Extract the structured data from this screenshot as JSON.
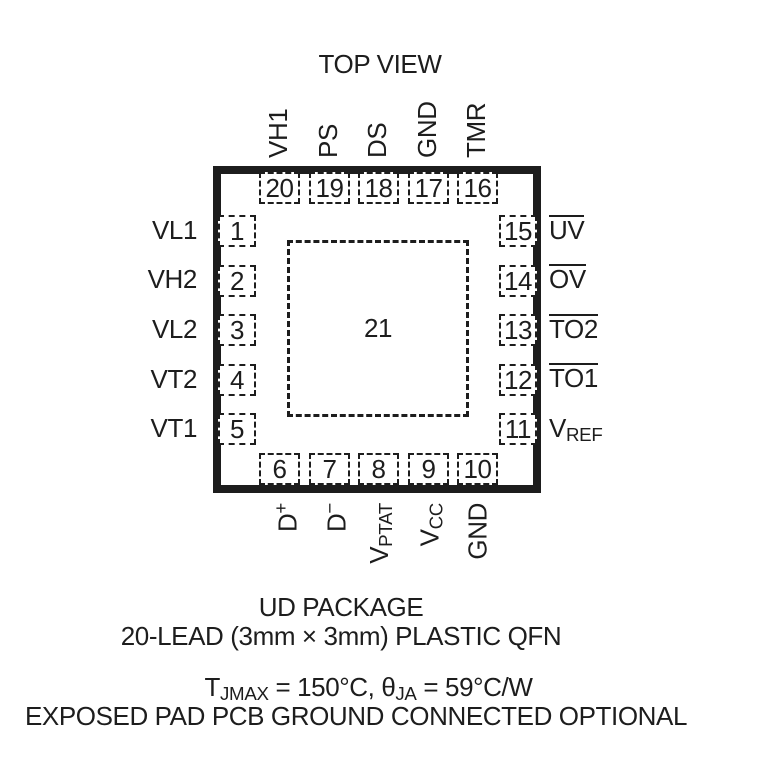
{
  "title": "TOP VIEW",
  "ink_color": "#1d1d1d",
  "package": {
    "center_pad_number": "21",
    "top_pins": [
      {
        "number": "20",
        "label": "VH1"
      },
      {
        "number": "19",
        "label": "PS"
      },
      {
        "number": "18",
        "label": "DS"
      },
      {
        "number": "17",
        "label": "GND"
      },
      {
        "number": "16",
        "label": "TMR"
      }
    ],
    "left_pins": [
      {
        "number": "1",
        "label": "VL1"
      },
      {
        "number": "2",
        "label": "VH2"
      },
      {
        "number": "3",
        "label": "VL2"
      },
      {
        "number": "4",
        "label": "VT2"
      },
      {
        "number": "5",
        "label": "VT1"
      }
    ],
    "right_pins": [
      {
        "number": "15",
        "label": "UV",
        "overline": true
      },
      {
        "number": "14",
        "label": "OV",
        "overline": true
      },
      {
        "number": "13",
        "label": "TO2",
        "overline": true
      },
      {
        "number": "12",
        "label": "TO1",
        "overline": true
      },
      {
        "number": "11",
        "label": "V",
        "sub": "REF"
      }
    ],
    "bottom_pins": [
      {
        "number": "6",
        "label": "D",
        "sup": "+"
      },
      {
        "number": "7",
        "label": "D",
        "sup": "−"
      },
      {
        "number": "8",
        "label": "V",
        "sub": "PTAT"
      },
      {
        "number": "9",
        "label": "V",
        "sub": "CC"
      },
      {
        "number": "10",
        "label": "GND"
      }
    ]
  },
  "footer": {
    "package_name": "UD PACKAGE",
    "package_desc": "20-LEAD (3mm × 3mm) PLASTIC QFN",
    "thermal": {
      "t1": "T",
      "t1_sub": "JMAX",
      "t2": " = 150°C, ",
      "theta": "θ",
      "theta_sub": "JA",
      "t3": " = 59°C/W"
    },
    "note": "EXPOSED PAD PCB GROUND CONNECTED OPTIONAL"
  }
}
